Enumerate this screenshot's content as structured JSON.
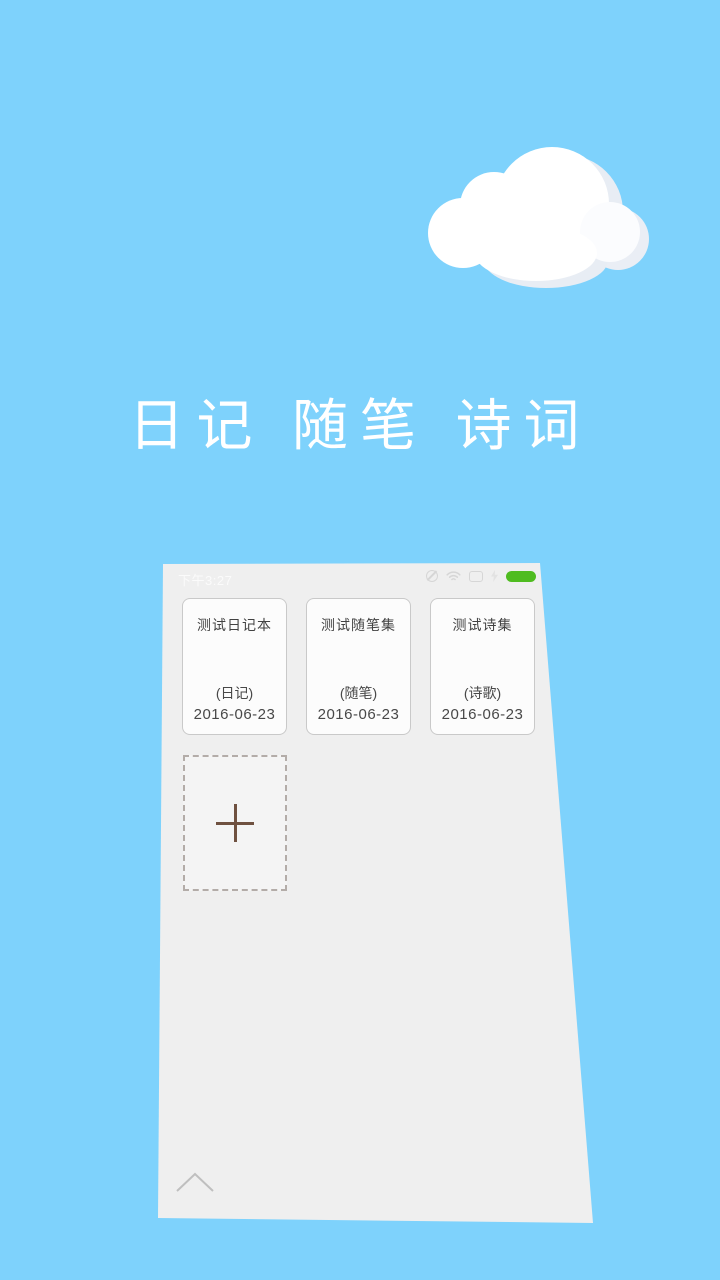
{
  "wallpaper": {
    "title": "日记 随笔 诗词",
    "colors": {
      "sky": "#7ed2fc",
      "cloud_white": "#ffffff",
      "cloud_shade": "#e8edf4"
    }
  },
  "screenshot": {
    "status_bar": {
      "time": "下午3:27",
      "icons": [
        "mute-icon",
        "wifi-icon",
        "sim-card-icon",
        "charging-bolt-icon",
        "battery-icon"
      ],
      "battery_color": "#4fbc20"
    },
    "notebooks": [
      {
        "title": "测试日记本",
        "category": "(日记)",
        "date": "2016-06-23"
      },
      {
        "title": "测试随笔集",
        "category": "(随笔)",
        "date": "2016-06-23"
      },
      {
        "title": "测试诗集",
        "category": "(诗歌)",
        "date": "2016-06-23"
      }
    ],
    "colors": {
      "screen_bg": "#efefef",
      "plus_brown": "#6f5140"
    }
  }
}
